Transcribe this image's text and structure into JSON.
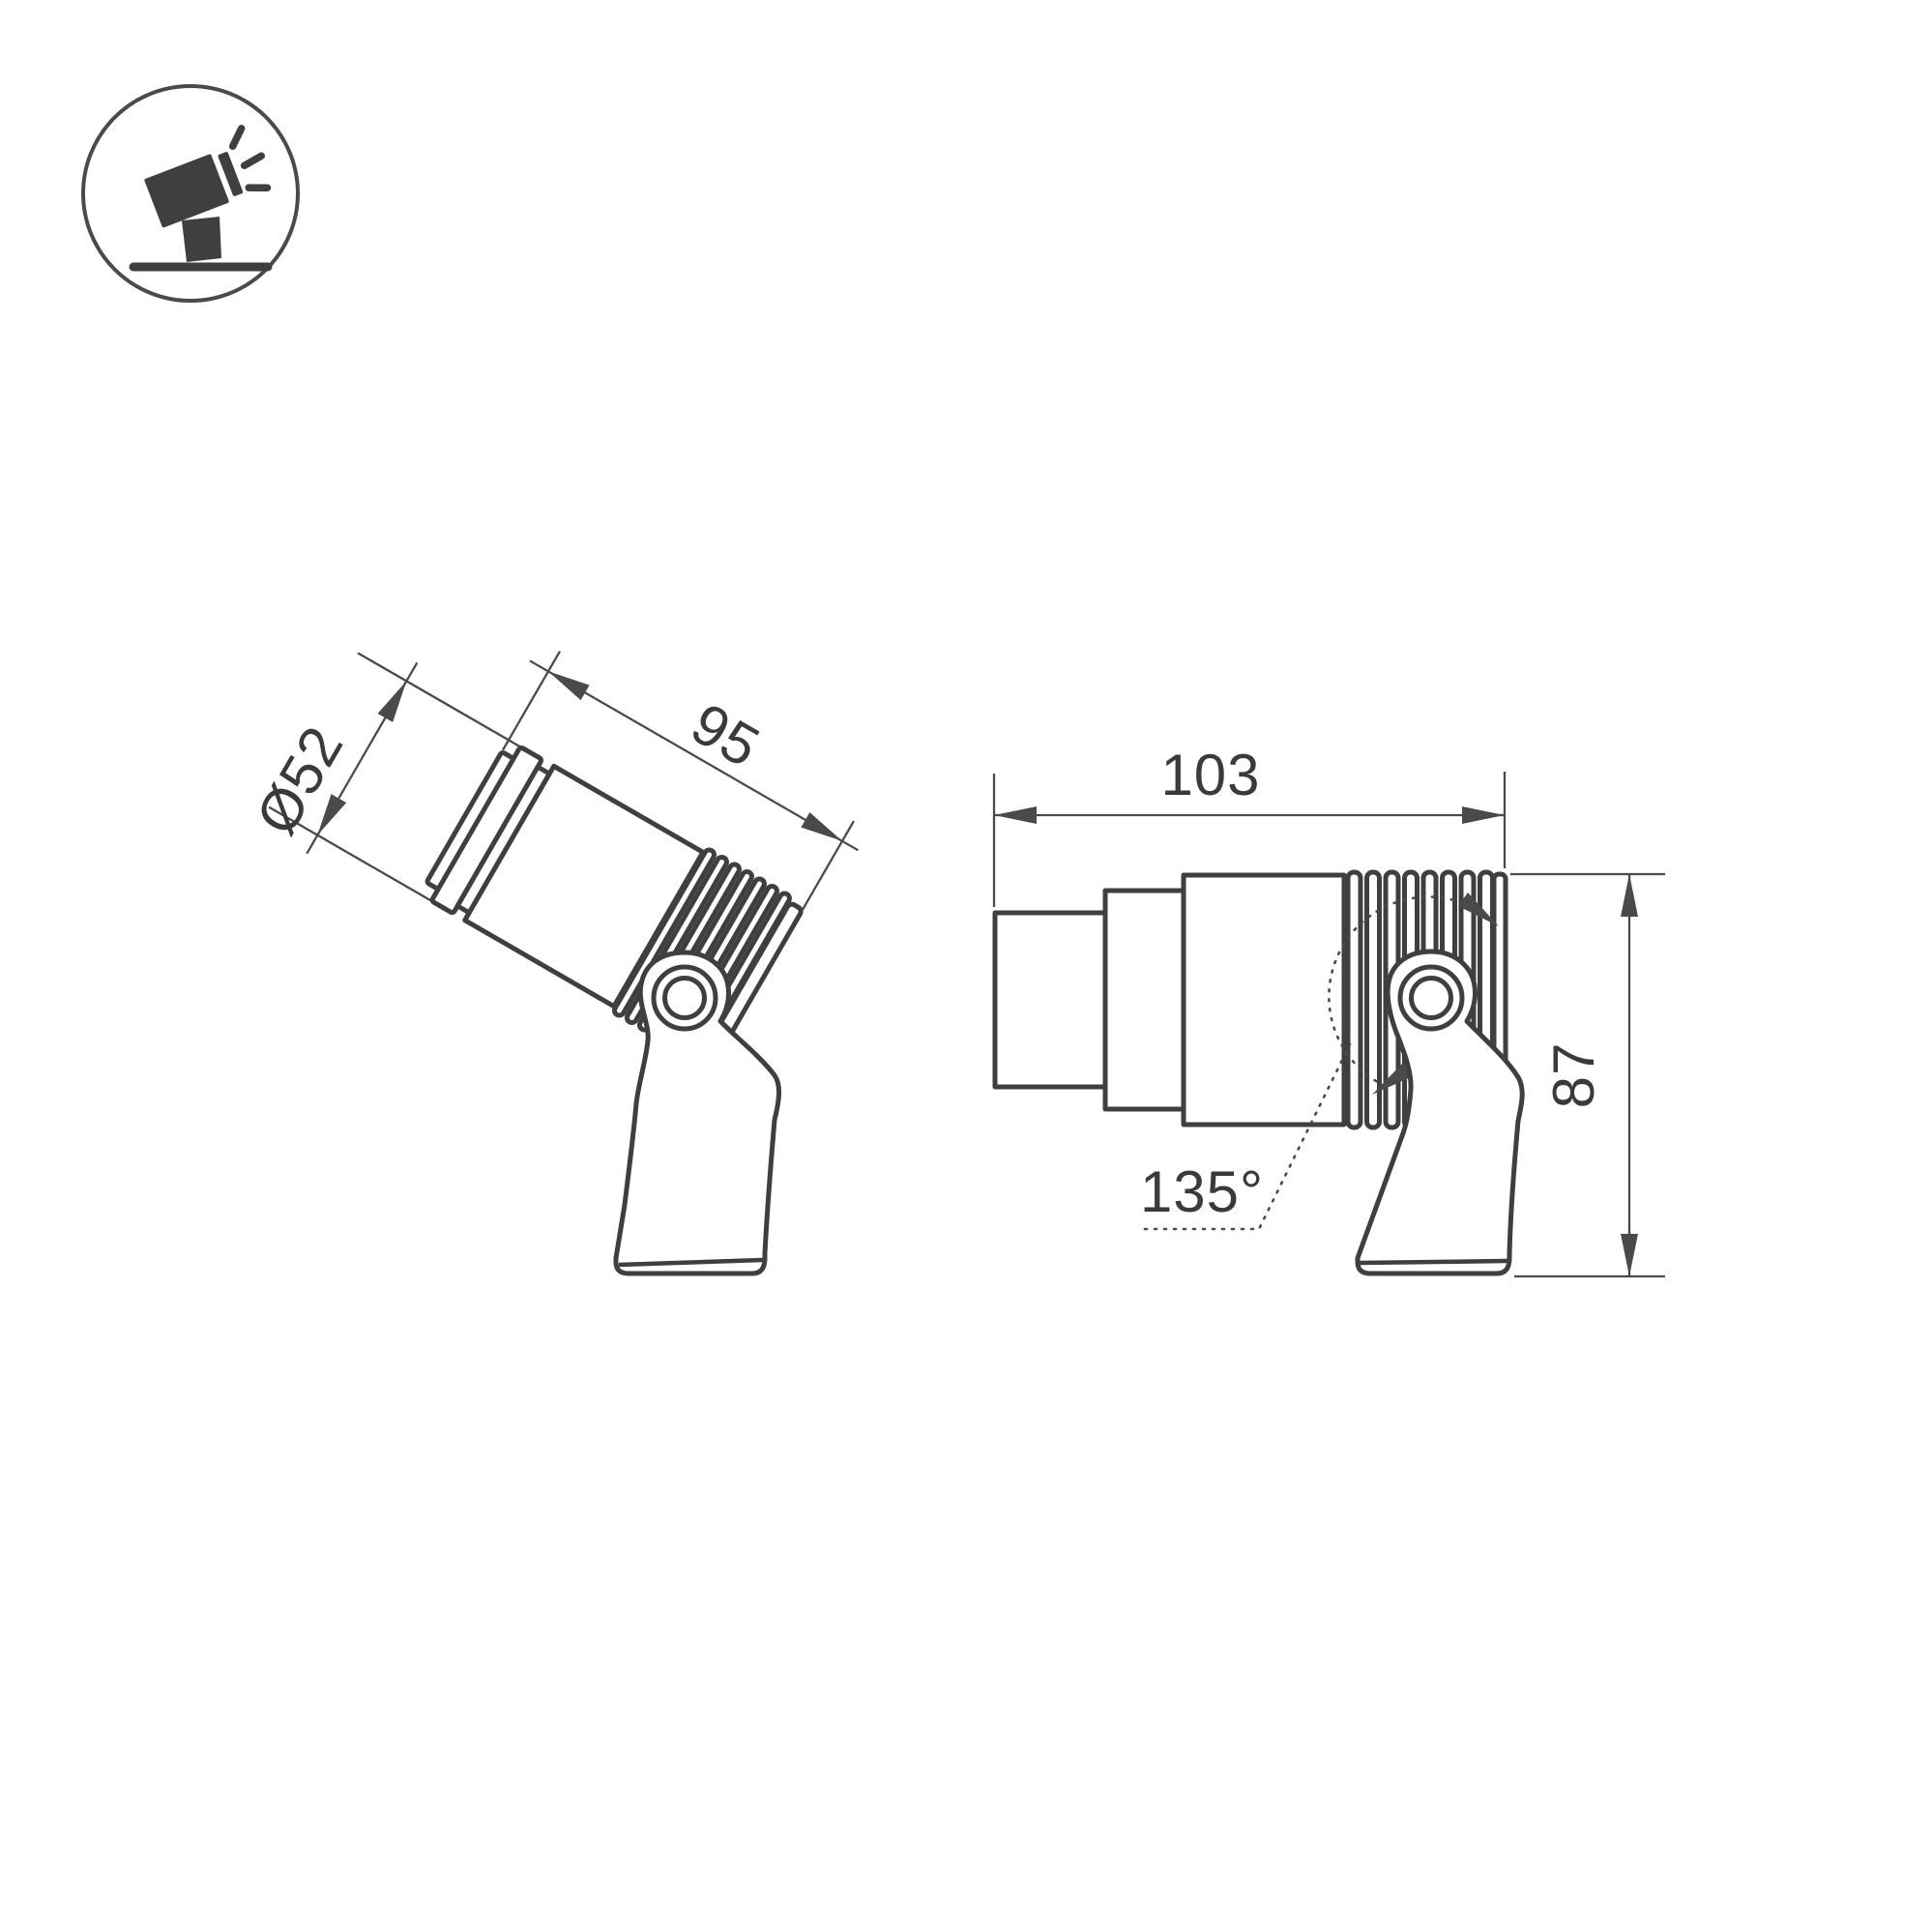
{
  "page": {
    "background": "#ffffff",
    "line_color": "#3f3f3f",
    "dimension_color": "#4a4a4a"
  },
  "icon": {
    "name": "tilted-spotlight-icon"
  },
  "views": {
    "tilted": {
      "title": "tilted-spotlight-view",
      "labels": {
        "diameter": "Ø52",
        "length": "95"
      }
    },
    "side": {
      "title": "side-spotlight-view",
      "labels": {
        "length": "103",
        "height": "87",
        "tilt_range": "135°"
      }
    }
  }
}
